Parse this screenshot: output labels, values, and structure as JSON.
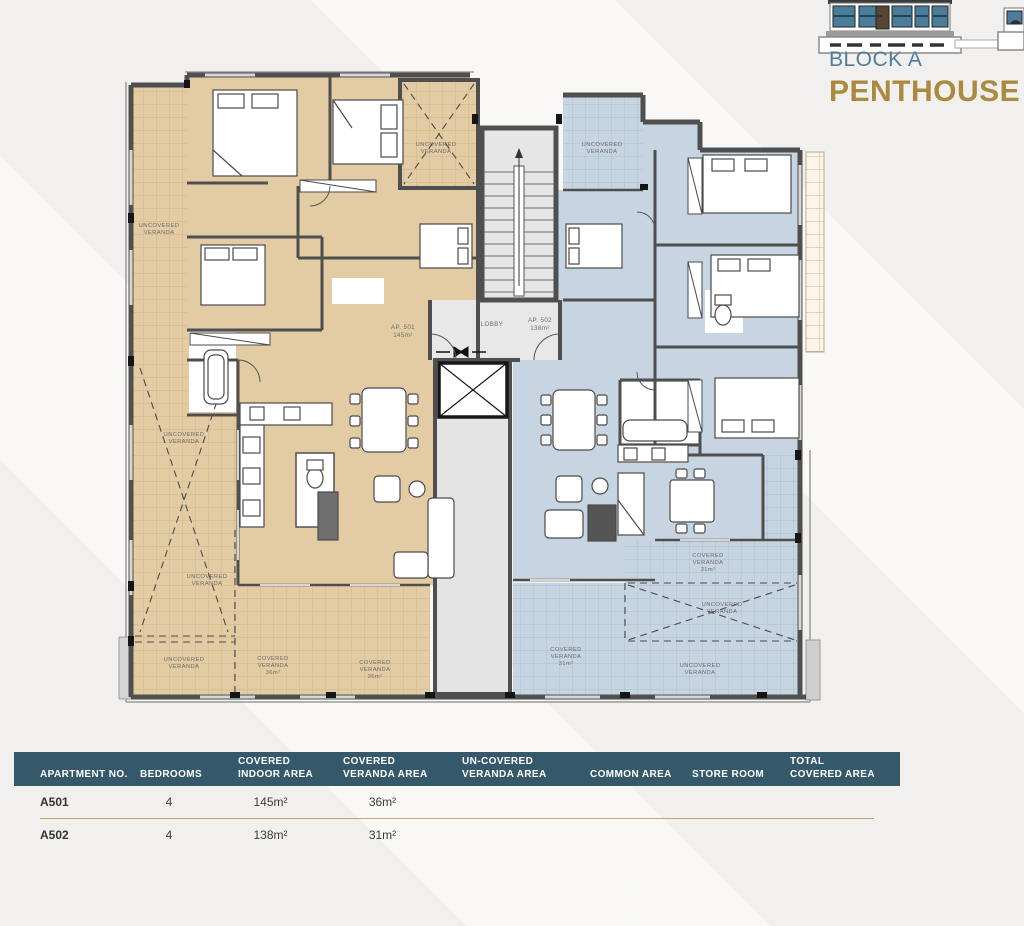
{
  "title_block": {
    "block": "BLOCK A",
    "name": "PENTHOUSE",
    "block_color": "#4e7d9c",
    "name_color": "#aa8a3e"
  },
  "plan": {
    "colors": {
      "unit_a501_fill": "#e3cca4",
      "unit_a502_fill": "#c6d5e1",
      "core_fill": "#e6e6e6",
      "wall": "#4f4f4f",
      "grid_tan": "#cdb387",
      "grid_blue": "#a7bfd0"
    },
    "labels": {
      "uncovered": "UNCOVERED",
      "covered": "COVERED",
      "veranda": "VERANDA",
      "area_36": "36m²",
      "area_31": "31m²",
      "lobby": "LOBBY",
      "ap1_no": "AP. 501",
      "ap1_area": "145m²",
      "ap2_no": "AP. 502",
      "ap2_area": "138m²"
    }
  },
  "table": {
    "header_color": "#35596b",
    "divider_color": "#c9a268",
    "columns": [
      "APARTMENT NO.",
      "BEDROOMS",
      "COVERED\nINDOOR AREA",
      "COVERED\nVERANDA AREA",
      "UN-COVERED\nVERANDA AREA",
      "COMMON AREA",
      "STORE ROOM",
      "TOTAL\nCOVERED AREA"
    ],
    "rows": [
      [
        "A501",
        "4",
        "145m²",
        "36m²",
        "",
        "",
        "",
        ""
      ],
      [
        "A502",
        "4",
        "138m²",
        "31m²",
        "",
        "",
        "",
        ""
      ]
    ]
  }
}
